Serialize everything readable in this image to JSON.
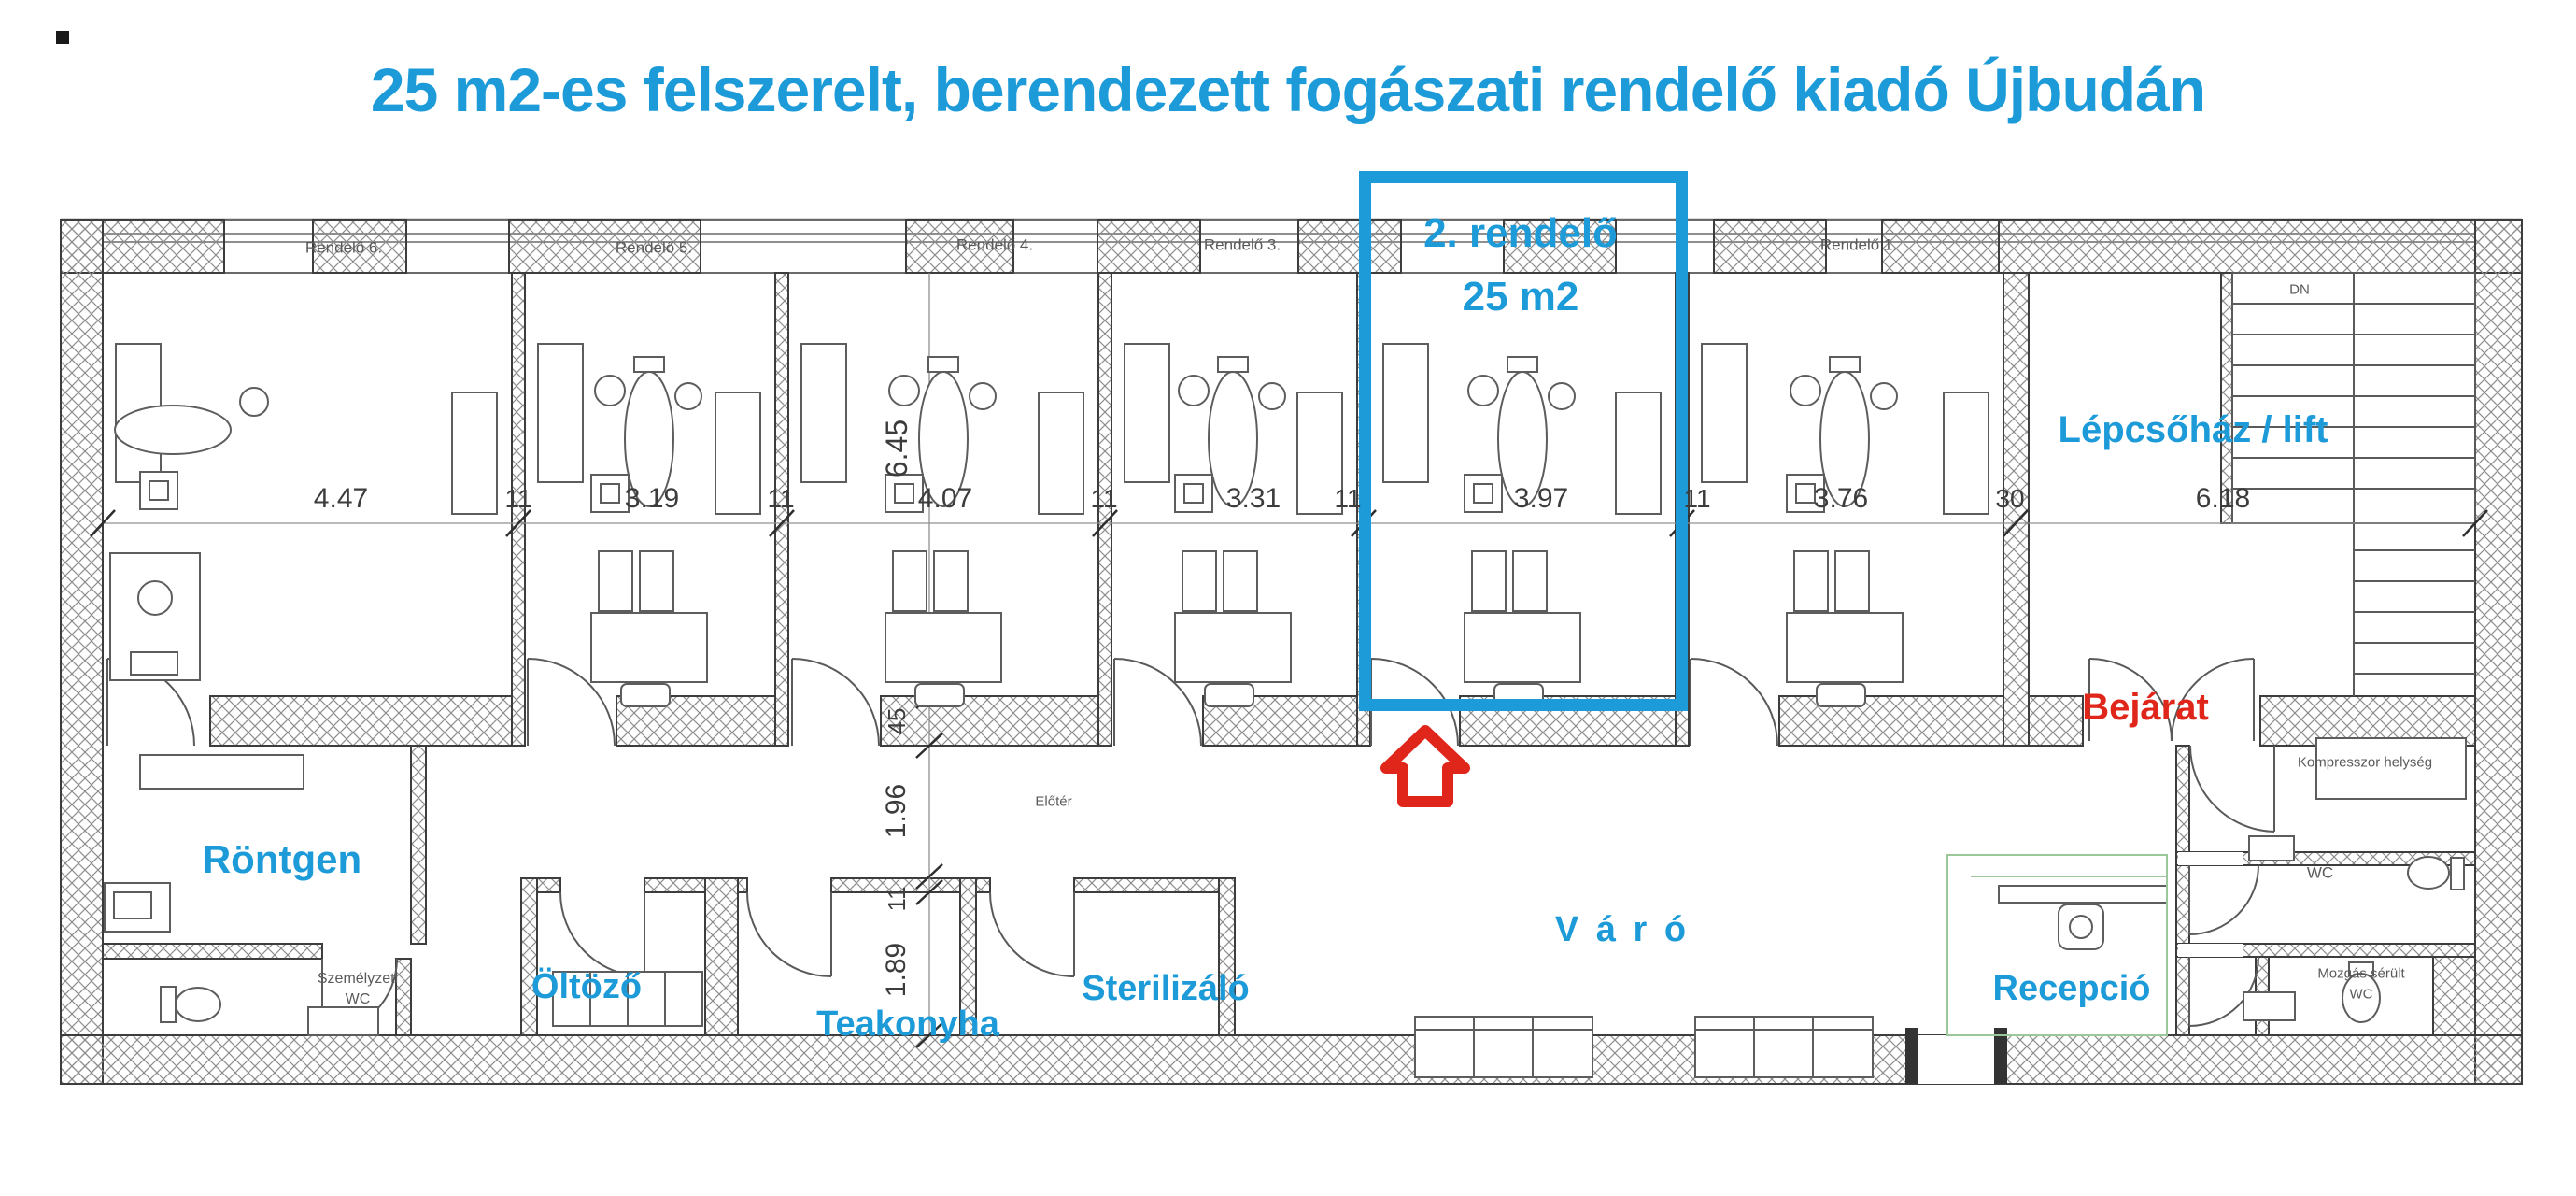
{
  "title": "25 m2-es felszerelt, berendezett fogászati rendelő kiadó Újbudán",
  "colors": {
    "accent": "#1d9bd8",
    "red": "#e0251b",
    "wall_line": "#3d3d3d"
  },
  "highlight": {
    "room_name": "2. rendelő",
    "room_area": "25 m2"
  },
  "top_rooms": {
    "r6": "Rendelő 6.",
    "r5": "Rendelő 5.",
    "r4": "Rendelő 4.",
    "r3": "Rendelő 3.",
    "r1": "Rendelő 1."
  },
  "areas": {
    "stairs": "Lépcsőház / lift",
    "stairs_dn": "DN",
    "xray": "Röntgen",
    "dressing": "Öltöző",
    "kitchen": "Teakonyha",
    "sterilizing": "Sterilizáló",
    "waiting": "V á r ó",
    "reception": "Recepció",
    "entrance": "Bejárat",
    "hall": "Előtér",
    "staff_wc_line1": "Személyzeti",
    "staff_wc_line2": "WC",
    "compressor": "Kompresszor helység",
    "wc": "WC",
    "disabled_wc_line1": "Mozgás sérült",
    "disabled_wc_line2": "WC"
  },
  "dims": {
    "top": [
      "4.47",
      "11",
      "3.19",
      "11",
      "4.07",
      "11",
      "3.31",
      "11",
      "3.97",
      "11",
      "3.76",
      "30",
      "6.18"
    ],
    "left": [
      "6.45",
      "45",
      "1.96",
      "11",
      "1.89"
    ]
  }
}
